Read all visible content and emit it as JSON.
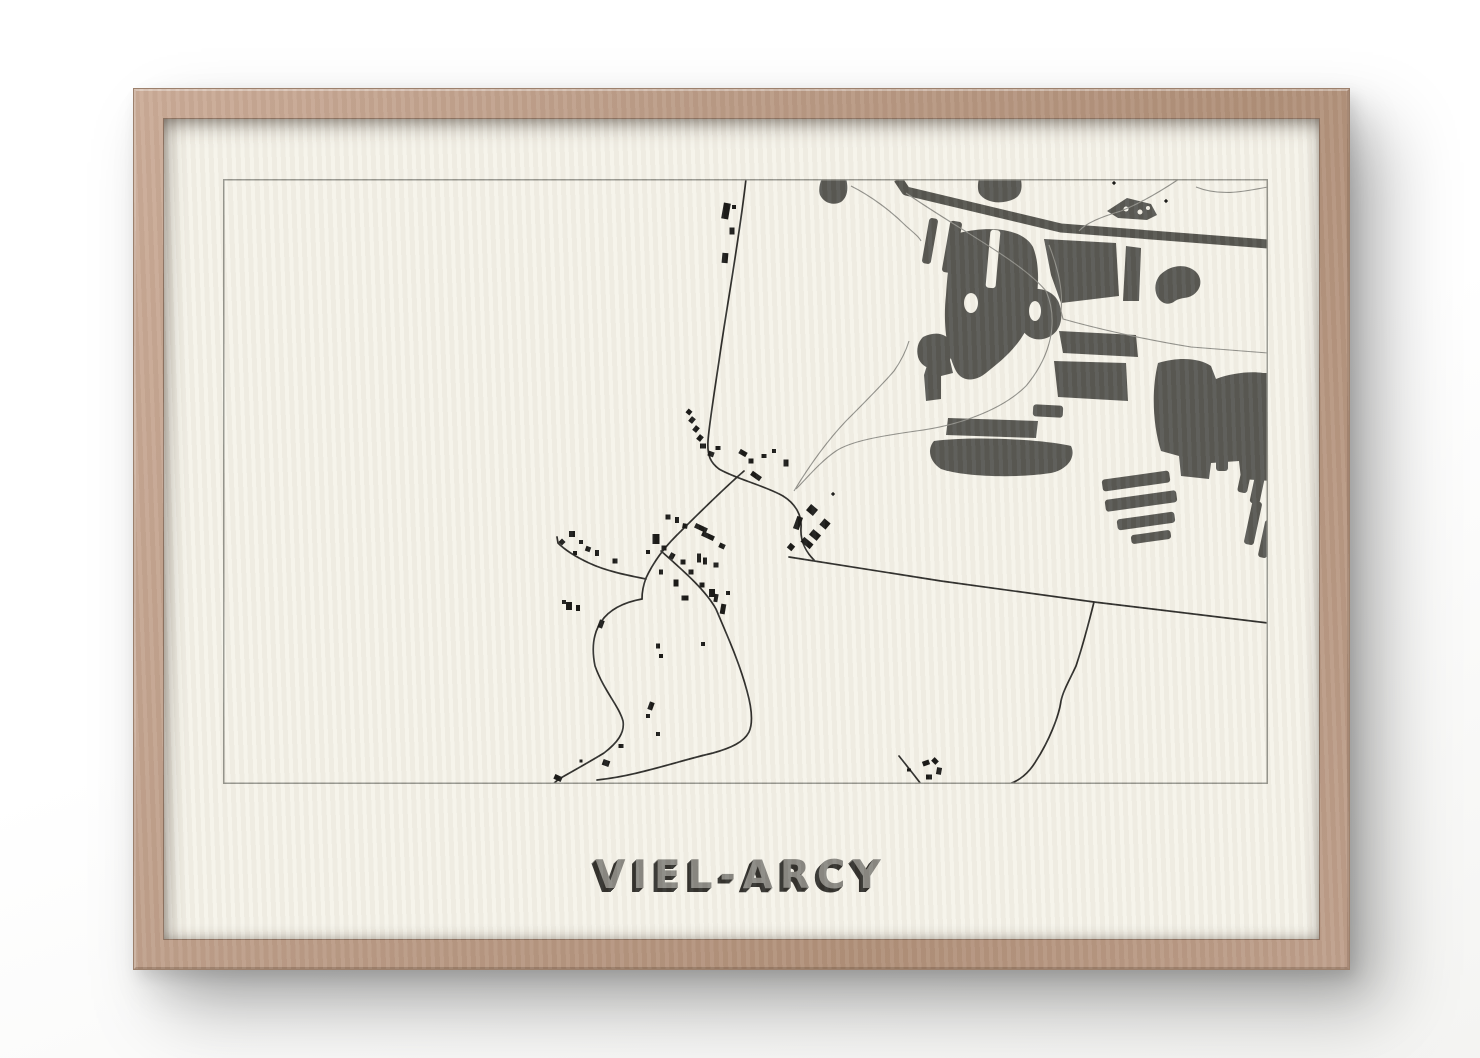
{
  "poster": {
    "title": "VIEL-ARCY"
  },
  "frame": {
    "wood_light": "#cbac98",
    "wood_dark": "#a5866f"
  },
  "paper": {
    "color": "#f5f3ea"
  },
  "map": {
    "width": 1045,
    "height": 605,
    "border_color": "#97978f",
    "palette": {
      "forest": "#585853",
      "band": "#55554f",
      "thin_road": "#90908a",
      "dark_road": "#2e2e2b",
      "building": "#1a1a18",
      "paper": "#f5f3ea"
    },
    "band": {
      "d": "M675,0 L683,12 L838,49 L1045,65",
      "width": 9
    },
    "forest_paths": [
      "M601,-4 L622,-4 C626,8 625,18 618,23 C610,27 601,24 597,16 C595,10 597,2 601,-4 Z",
      "M757,-4 L797,-4 C800,8 799,16 791,20 C778,26 762,24 756,14 C754,9 755,2 757,-4 Z",
      "M884,32 L904,19 L928,25 L934,36 L924,41 L895,39 Z",
      "M937,96 C947,86 962,84 972,92 C980,99 979,110 970,116 C964,120 958,118 952,122 C946,127 938,125 934,117 C931,110 932,102 937,96 Z",
      "M736,54 C768,46 800,50 810,68 C818,88 816,118 808,140 C798,167 778,182 763,194 C753,202 740,204 733,192 C723,172 720,142 723,116 C725,86 728,62 736,54 Z",
      "M798,114 C812,106 830,110 836,124 C841,138 838,152 826,158 C816,163 804,160 799,150 C794,140 792,124 798,114 Z",
      "M700,158 C712,152 724,154 728,164 C732,174 728,184 718,188 C708,192 698,188 695,178 C693,170 695,163 700,158 Z",
      "M706,180 L726,177 L730,194 L718,197 L718,220 L703,222 L701,196 Z",
      "M821,60 L893,64 L896,117 L838,124 L828,96 Z",
      "M903,67 L918,69 L916,122 L900,122 Z",
      "M836,152 L913,156 L915,178 L840,174 Z",
      "M831,182 L903,184 L905,222 L835,218 Z",
      "M725,239 L815,242 L813,259 L723,256 Z",
      "M711,262 C748,257 818,260 848,267 C853,277 846,290 828,294 C788,300 738,297 718,290 C706,282 704,270 711,262 Z",
      "M935,184 C958,177 978,180 988,187 L993,200 C1008,194 1028,192 1040,194 L1049,194 L1049,302 L1018,300 L1016,282 L988,284 L986,300 L958,297 L956,277 L938,272 C930,247 928,212 935,184 Z"
    ],
    "forest_bars": [
      [
        707,
        62,
        9,
        46,
        10
      ],
      [
        729,
        68,
        12,
        52,
        10
      ],
      [
        825,
        232,
        30,
        12,
        3
      ],
      [
        913,
        302,
        68,
        12,
        -8
      ],
      [
        918,
        322,
        72,
        12,
        -8
      ],
      [
        923,
        342,
        58,
        11,
        -8
      ],
      [
        928,
        358,
        40,
        9,
        -8
      ],
      [
        999,
        283,
        12,
        18,
        0
      ],
      [
        1023,
        294,
        10,
        40,
        12
      ],
      [
        1036,
        302,
        10,
        46,
        12
      ],
      [
        1030,
        344,
        10,
        44,
        12
      ],
      [
        1043,
        360,
        9,
        38,
        12
      ]
    ],
    "paper_cutouts": {
      "bars": [
        [
          770,
          80,
          10,
          58,
          5
        ]
      ],
      "ellipses": [
        [
          748,
          124,
          7,
          10
        ],
        [
          812,
          132,
          6,
          10
        ]
      ]
    },
    "white_dots": [
      [
        903,
        30,
        2.5
      ],
      [
        917,
        33,
        2.5
      ],
      [
        925,
        29,
        2
      ]
    ],
    "thin_roads": [
      "M683,14 C738,52 798,82 823,112 C836,142 828,177 803,207 C778,232 733,247 693,252 C658,257 628,262 613,272 C598,282 583,300 573,310",
      "M826,66 C836,92 840,112 838,132 L840,140 C868,148 918,160 968,168 L1045,174",
      "M956,0 C938,12 918,24 898,32 C878,38 863,44 856,52",
      "M973,8 C998,18 1023,12 1045,8",
      "M571,312 C588,284 604,262 623,242 C643,222 658,207 671,192 C678,182 683,172 686,162",
      "M628,7 C648,17 668,32 683,47 C691,54 696,58 698,62"
    ],
    "dark_roads": [
      "M523,0 C516,62 503,132 496,182 C490,222 486,247 485,262 C484,277 488,284 496,290 C513,300 543,307 560,317 C573,325 579,337 578,349 C577,364 585,375 591,381",
      "M521,292 C498,312 473,337 453,357 C440,370 430,384 423,399 C420,407 419,414 419,420",
      "M423,400 C403,396 383,392 366,384 C351,377 341,370 335,364 L334,358",
      "M419,420 C370,429 367,462 372,487 C381,512 396,527 400,542 C402,554 394,564 381,574 C368,582 350,592 336,600 L330,605",
      "M438,372 C463,394 483,412 493,430 C503,454 516,482 524,512 C529,530 530,544 526,553 C521,563 508,569 490,574 C468,579 443,587 418,593 C398,598 383,600 374,601",
      "M566,378 L718,402 L871,423 L1045,444",
      "M871,423 C865,447 858,472 853,487 C846,502 840,512 838,522 C836,537 826,562 813,582 C806,594 796,602 786,605",
      "M676,577 Q688,592 698,605"
    ],
    "buildings": [
      [
        503,
        32,
        7,
        16,
        10
      ],
      [
        511,
        28,
        4,
        4,
        0
      ],
      [
        509,
        52,
        5,
        7,
        0
      ],
      [
        502,
        79,
        6,
        10,
        5
      ],
      [
        466,
        233,
        5,
        5,
        40
      ],
      [
        469,
        241,
        5,
        6,
        40
      ],
      [
        473,
        250,
        5,
        6,
        40
      ],
      [
        477,
        259,
        5,
        6,
        40
      ],
      [
        480,
        267,
        6,
        5,
        0
      ],
      [
        488,
        275,
        6,
        5,
        20
      ],
      [
        495,
        269,
        5,
        4,
        0
      ],
      [
        520,
        274,
        8,
        5,
        30
      ],
      [
        528,
        282,
        5,
        5,
        0
      ],
      [
        533,
        297,
        11,
        5,
        35
      ],
      [
        541,
        277,
        5,
        4,
        0
      ],
      [
        551,
        272,
        4,
        4,
        0
      ],
      [
        563,
        284,
        5,
        7,
        0
      ],
      [
        589,
        331,
        9,
        8,
        40
      ],
      [
        575,
        344,
        6,
        13,
        20
      ],
      [
        602,
        345,
        8,
        8,
        40
      ],
      [
        592,
        356,
        10,
        7,
        40
      ],
      [
        584,
        364,
        12,
        6,
        40
      ],
      [
        568,
        368,
        6,
        6,
        40
      ],
      [
        610,
        315,
        3,
        3,
        45
      ],
      [
        478,
        349,
        13,
        5,
        25
      ],
      [
        485,
        357,
        13,
        5,
        25
      ],
      [
        499,
        367,
        6,
        5,
        25
      ],
      [
        462,
        347,
        5,
        5,
        10
      ],
      [
        454,
        341,
        4,
        6,
        0
      ],
      [
        445,
        338,
        5,
        5,
        0
      ],
      [
        433,
        360,
        7,
        10,
        0
      ],
      [
        441,
        369,
        5,
        5,
        0
      ],
      [
        425,
        373,
        4,
        4,
        0
      ],
      [
        449,
        377,
        5,
        6,
        30
      ],
      [
        460,
        383,
        5,
        5,
        0
      ],
      [
        476,
        379,
        4,
        9,
        0
      ],
      [
        482,
        382,
        4,
        7,
        0
      ],
      [
        493,
        386,
        5,
        5,
        0
      ],
      [
        468,
        393,
        5,
        5,
        0
      ],
      [
        438,
        393,
        4,
        5,
        0
      ],
      [
        453,
        404,
        5,
        7,
        0
      ],
      [
        479,
        406,
        5,
        5,
        0
      ],
      [
        489,
        414,
        6,
        8,
        0
      ],
      [
        462,
        419,
        7,
        5,
        0
      ],
      [
        349,
        355,
        6,
        6,
        0
      ],
      [
        339,
        363,
        5,
        5,
        45
      ],
      [
        358,
        363,
        4,
        4,
        0
      ],
      [
        365,
        370,
        5,
        5,
        20
      ],
      [
        374,
        374,
        4,
        6,
        0
      ],
      [
        352,
        374,
        4,
        4,
        0
      ],
      [
        392,
        382,
        5,
        5,
        0
      ],
      [
        346,
        427,
        6,
        8,
        0
      ],
      [
        355,
        429,
        4,
        6,
        0
      ],
      [
        341,
        423,
        4,
        4,
        0
      ],
      [
        378,
        445,
        5,
        8,
        20
      ],
      [
        435,
        467,
        4,
        5,
        0
      ],
      [
        438,
        477,
        4,
        4,
        0
      ],
      [
        428,
        527,
        5,
        8,
        20
      ],
      [
        425,
        537,
        4,
        4,
        0
      ],
      [
        435,
        555,
        4,
        4,
        0
      ],
      [
        398,
        567,
        5,
        4,
        0
      ],
      [
        383,
        584,
        7,
        6,
        20
      ],
      [
        358,
        582,
        3,
        3,
        0
      ],
      [
        335,
        599,
        8,
        5,
        25
      ],
      [
        493,
        419,
        4,
        8,
        10
      ],
      [
        500,
        430,
        5,
        10,
        10
      ],
      [
        505,
        414,
        4,
        4,
        0
      ],
      [
        480,
        465,
        4,
        4,
        0
      ],
      [
        703,
        584,
        7,
        5,
        -20
      ],
      [
        712,
        582,
        6,
        5,
        45
      ],
      [
        716,
        592,
        5,
        7,
        10
      ],
      [
        706,
        598,
        6,
        5,
        0
      ],
      [
        686,
        591,
        4,
        3,
        0
      ],
      [
        891,
        4,
        3,
        3,
        45
      ],
      [
        943,
        22,
        3,
        3,
        45
      ]
    ]
  }
}
